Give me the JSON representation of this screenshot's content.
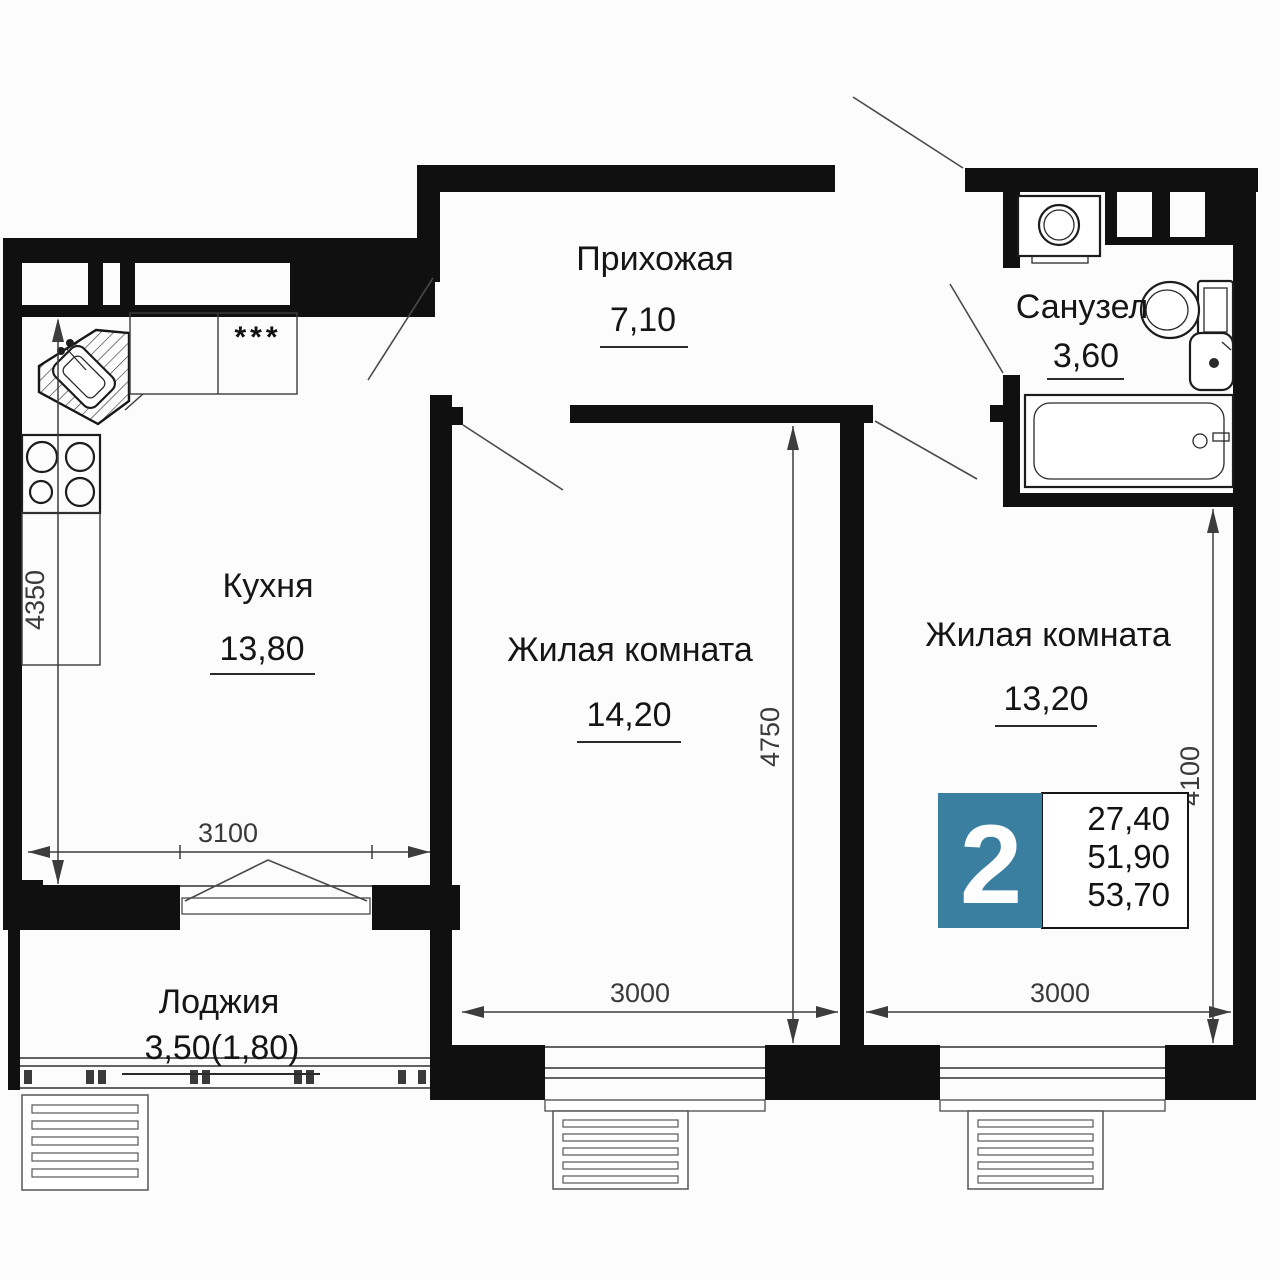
{
  "rooms": [
    {
      "name": "Прихожая",
      "area": "7,10"
    },
    {
      "name": "Санузел",
      "area": "3,60"
    },
    {
      "name": "Кухня",
      "area": "13,80"
    },
    {
      "name": "Жилая комната",
      "area": "14,20"
    },
    {
      "name": "Жилая комната",
      "area": "13,20"
    },
    {
      "name": "Лоджия",
      "area": "3,50(1,80)"
    }
  ],
  "dimensions": [
    {
      "id": "kitchen-depth",
      "value": "4350"
    },
    {
      "id": "kitchen-width",
      "value": "3100"
    },
    {
      "id": "living-room-1-depth",
      "value": "4750"
    },
    {
      "id": "living-room-1-width",
      "value": "3000"
    },
    {
      "id": "living-room-2-depth",
      "value": "4100"
    },
    {
      "id": "living-room-2-width",
      "value": "3000"
    }
  ],
  "badge": {
    "rooms_count": "2",
    "living_area": "27,40",
    "area_without_loggia": "51,90",
    "total_area": "53,70",
    "accent_color": "#3a7f9f"
  },
  "kitchen_appliance_symbol": "***",
  "colors": {
    "walls": "#101010",
    "background": "#fcfcfc",
    "accent": "#3a7f9f"
  }
}
